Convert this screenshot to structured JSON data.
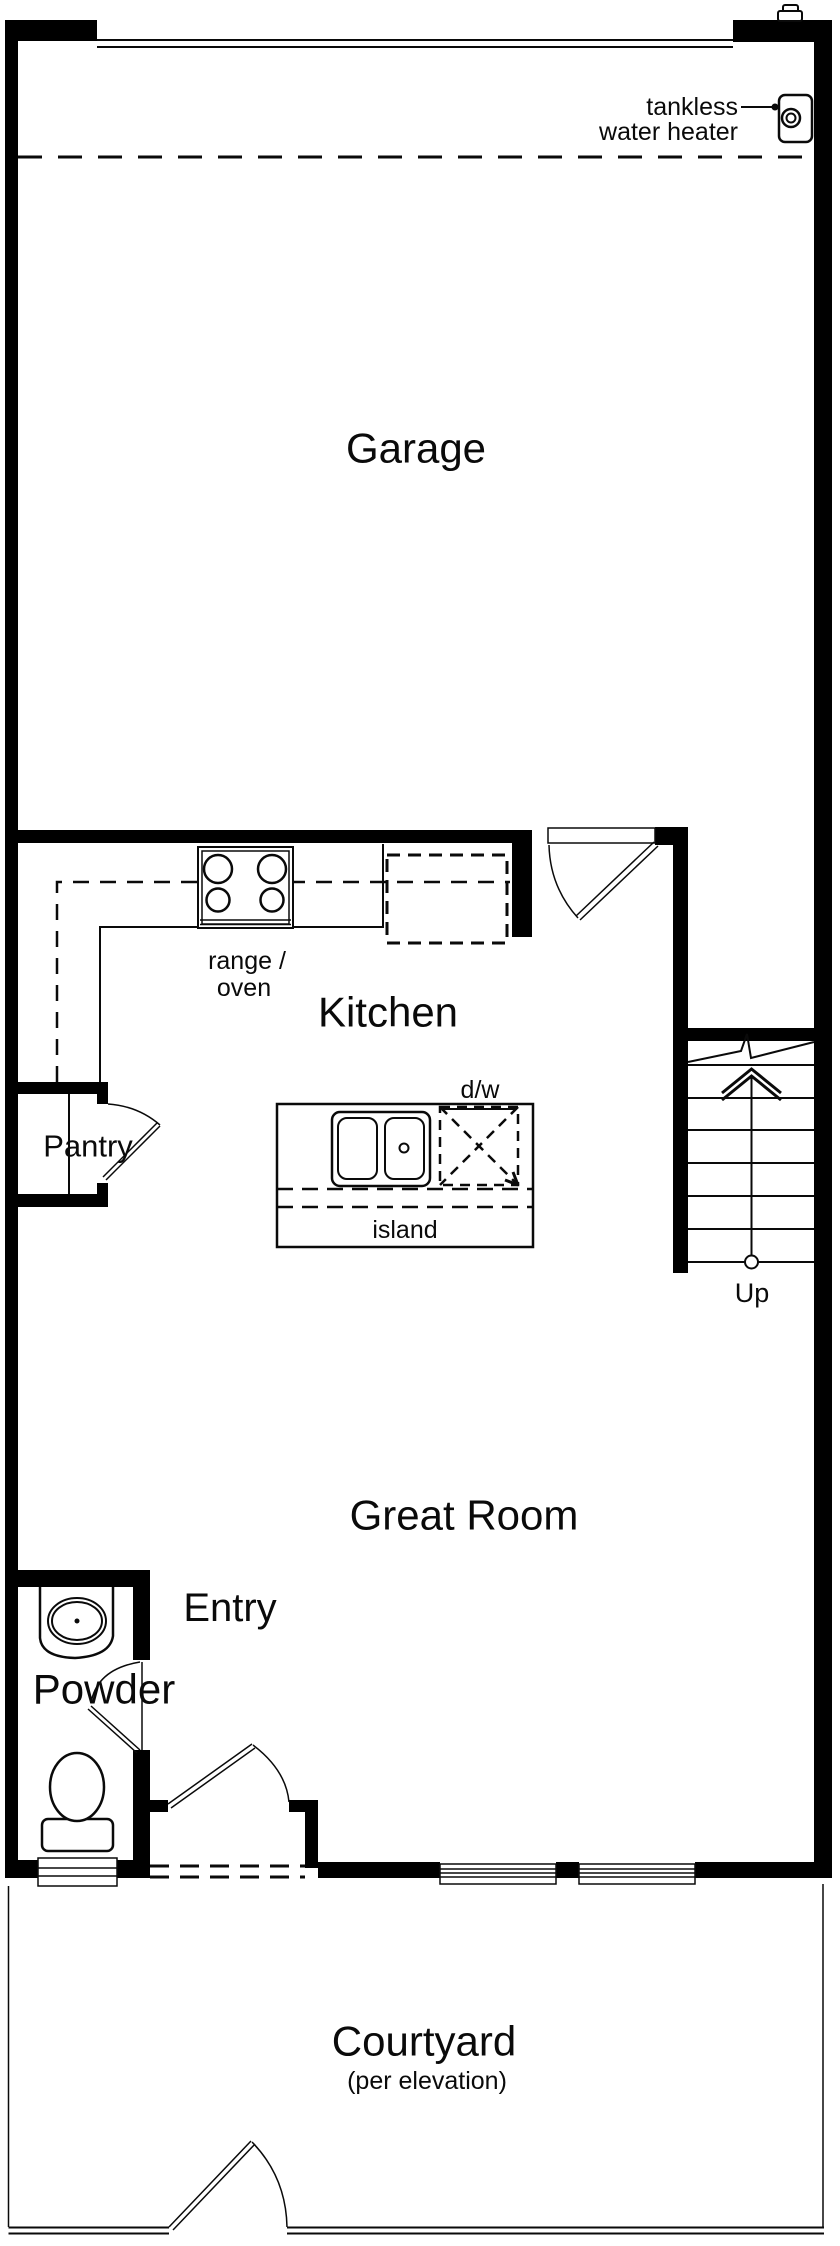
{
  "rooms": {
    "garage": "Garage",
    "kitchen": "Kitchen",
    "great_room": "Great Room",
    "entry": "Entry",
    "powder": "Powder",
    "pantry": "Pantry",
    "courtyard": "Courtyard",
    "courtyard_note": "(per elevation)"
  },
  "fixtures": {
    "water_heater_line1": "tankless",
    "water_heater_line2": "water heater",
    "range_line1": "range /",
    "range_line2": "oven",
    "dishwasher": "d/w",
    "island": "island",
    "stairs_up": "Up"
  },
  "colors": {
    "wall": "#000000",
    "line": "#0a0a0a",
    "background": "#ffffff"
  }
}
